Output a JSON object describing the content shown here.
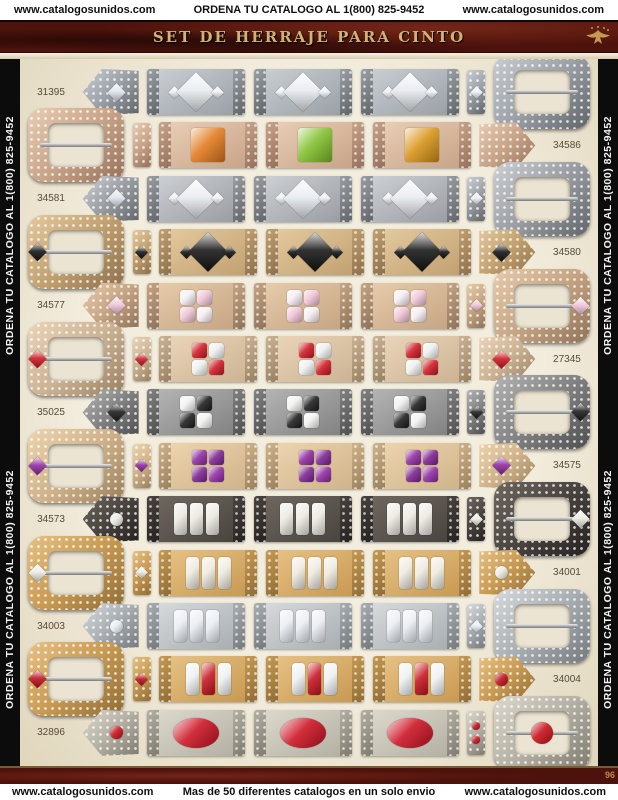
{
  "top_bar": {
    "left": "www.catalogosunidos.com",
    "center": "ORDENA TU CATALOGO AL 1(800) 825-9452",
    "right": "www.catalogosunidos.com"
  },
  "banner": {
    "title": "SET DE HERRAJE PARA CINTO"
  },
  "sidebars": {
    "left": [
      "ORDENA TU CATALOGO AL 1(800) 825-9452",
      "ORDENA TU CATALOGO AL 1(800) 825-9452"
    ],
    "right": [
      "ORDENA TU CATALOGO AL 1(800) 825-9452",
      "ORDENA TU CATALOGO AL 1(800) 825-9452"
    ]
  },
  "bottom_bar": {
    "left": "www.catalogosunidos.com",
    "center": "Mas de 50 diferentes catalogos en un solo envio",
    "right": "www.catalogosunidos.com"
  },
  "page_number": "96",
  "theme": {
    "banner_bg": "#4c120c",
    "banner_text": "#d2b176",
    "sidebar_bg": "#0c0c0c",
    "page_bg": "#ece4d2",
    "accent_gold": "#c59a54"
  },
  "products": [
    {
      "sku": "31395",
      "buckle_side": "right",
      "stone_type": "diamond",
      "metal": "#9aa0a6",
      "metal_light": "#c9ced3",
      "metal_dark": "#5f6468",
      "loop_stones": [
        "#e8ebf0",
        "#e8ebf0",
        "#e8ebf0"
      ],
      "side_stone": "#eef0f4",
      "tip_stone": "#dde3ea",
      "keeper_stone": "#eef0f4",
      "buckle_stone": null
    },
    {
      "sku": "34586",
      "buckle_side": "left",
      "stone_type": "square",
      "metal": "#c8a488",
      "metal_light": "#e8cdb4",
      "metal_dark": "#96705a",
      "loop_stones": [
        "#e2791c",
        "#7fbf2a",
        "#d89418"
      ],
      "side_stone": null,
      "tip_stone": null,
      "keeper_stone": null,
      "buckle_stone": null
    },
    {
      "sku": "34581",
      "buckle_side": "right",
      "stone_type": "diamond",
      "metal": "#9a9ea3",
      "metal_light": "#ccd0d5",
      "metal_dark": "#62666b",
      "loop_stones": [
        "#e8ebf0",
        "#e8ebf0",
        "#e8ebf0"
      ],
      "side_stone": "#eef0f4",
      "tip_stone": "#dde3ea",
      "keeper_stone": "#eef0f4",
      "buckle_stone": null
    },
    {
      "sku": "34580",
      "buckle_side": "left",
      "stone_type": "diamond",
      "metal": "#c2a170",
      "metal_light": "#e3c99e",
      "metal_dark": "#8d6f4a",
      "loop_stones": [
        "#161616",
        "#161616",
        "#161616"
      ],
      "side_stone": "#121212",
      "tip_stone": "#141414",
      "keeper_stone": "#141414",
      "buckle_stone": "#141414"
    },
    {
      "sku": "34577",
      "buckle_side": "right",
      "stone_type": "grid",
      "metal": "#c6a584",
      "metal_light": "#e6cbaa",
      "metal_dark": "#8f7257",
      "grid_colors": [
        "#f4eef2",
        "#efc4d6",
        "#efc4d6",
        "#f4eef2"
      ],
      "tip_stone": "#efc4d6",
      "keeper_stone": "#efc4d6",
      "buckle_stone": "#efc4d6"
    },
    {
      "sku": "27345",
      "buckle_side": "left",
      "stone_type": "grid",
      "metal": "#ccb394",
      "metal_light": "#ead4b8",
      "metal_dark": "#97805f",
      "grid_colors": [
        "#d01822",
        "#eef0f0",
        "#eef0f0",
        "#d01822"
      ],
      "tip_stone": "#d01822",
      "keeper_stone": "#d01822",
      "buckle_stone": "#d01822"
    },
    {
      "sku": "35025",
      "buckle_side": "right",
      "stone_type": "grid",
      "metal": "#828282",
      "metal_light": "#b4b4b4",
      "metal_dark": "#4f4f4f",
      "grid_colors": [
        "#f2f2f0",
        "#1c1c1c",
        "#1c1c1c",
        "#f2f2f0"
      ],
      "tip_stone": "#1c1c1c",
      "keeper_stone": "#1c1c1c",
      "buckle_stone": "#1c1c1c"
    },
    {
      "sku": "34575",
      "buckle_side": "left",
      "stone_type": "grid",
      "metal": "#d0b38a",
      "metal_light": "#ecd4ae",
      "metal_dark": "#9a7f5a",
      "grid_colors": [
        "#8e2ba2",
        "#7c2390",
        "#7c2390",
        "#8e2ba2"
      ],
      "tip_stone": "#8e2ba2",
      "keeper_stone": "#8e2ba2",
      "buckle_stone": "#8e2ba2"
    },
    {
      "sku": "34573",
      "buckle_side": "right",
      "stone_type": "bars",
      "metal": "#4a443f",
      "metal_light": "#6e6760",
      "metal_dark": "#262220",
      "bar_colors": [
        "#eae8e0",
        "#eae8e0",
        "#eae8e0"
      ],
      "tip_stone": "#eceae2",
      "keeper_stone": "#eceae2",
      "buckle_stone": "#eceae2"
    },
    {
      "sku": "34001",
      "buckle_side": "left",
      "stone_type": "bars",
      "metal": "#c89a52",
      "metal_light": "#e6c184",
      "metal_dark": "#8f6c34",
      "bar_colors": [
        "#ece9df",
        "#ece9df",
        "#ece9df"
      ],
      "tip_stone": "#eceae2",
      "keeper_stone": "#eceae2",
      "buckle_stone": "#eceae2"
    },
    {
      "sku": "34003",
      "buckle_side": "right",
      "stone_type": "bars",
      "metal": "#a9aeb2",
      "metal_light": "#d6dadd",
      "metal_dark": "#74797d",
      "bar_colors": [
        "#e9edf2",
        "#e9edf2",
        "#e9edf2"
      ],
      "tip_stone": "#e8ecf2",
      "keeper_stone": "#e8ecf2",
      "buckle_stone": null
    },
    {
      "sku": "34004",
      "buckle_side": "left",
      "stone_type": "bars",
      "metal": "#c89a52",
      "metal_light": "#e6c184",
      "metal_dark": "#8f6c34",
      "bar_colors": [
        "#eef0f2",
        "#c61420",
        "#eef0f2"
      ],
      "tip_stone": "#c01020",
      "keeper_stone": "#c01020",
      "buckle_stone": "#c01020"
    },
    {
      "sku": "32896",
      "buckle_side": "right",
      "stone_type": "oval",
      "metal": "#b4b0a4",
      "metal_light": "#dcd8cc",
      "metal_dark": "#7e7a6e",
      "loop_stones": [
        "#cc1222",
        "#cc1222",
        "#cc1222"
      ],
      "side_stone": null,
      "tip_stone": "#c81018",
      "keeper_stone": "#c81018",
      "buckle_stone": "#c81018"
    }
  ]
}
